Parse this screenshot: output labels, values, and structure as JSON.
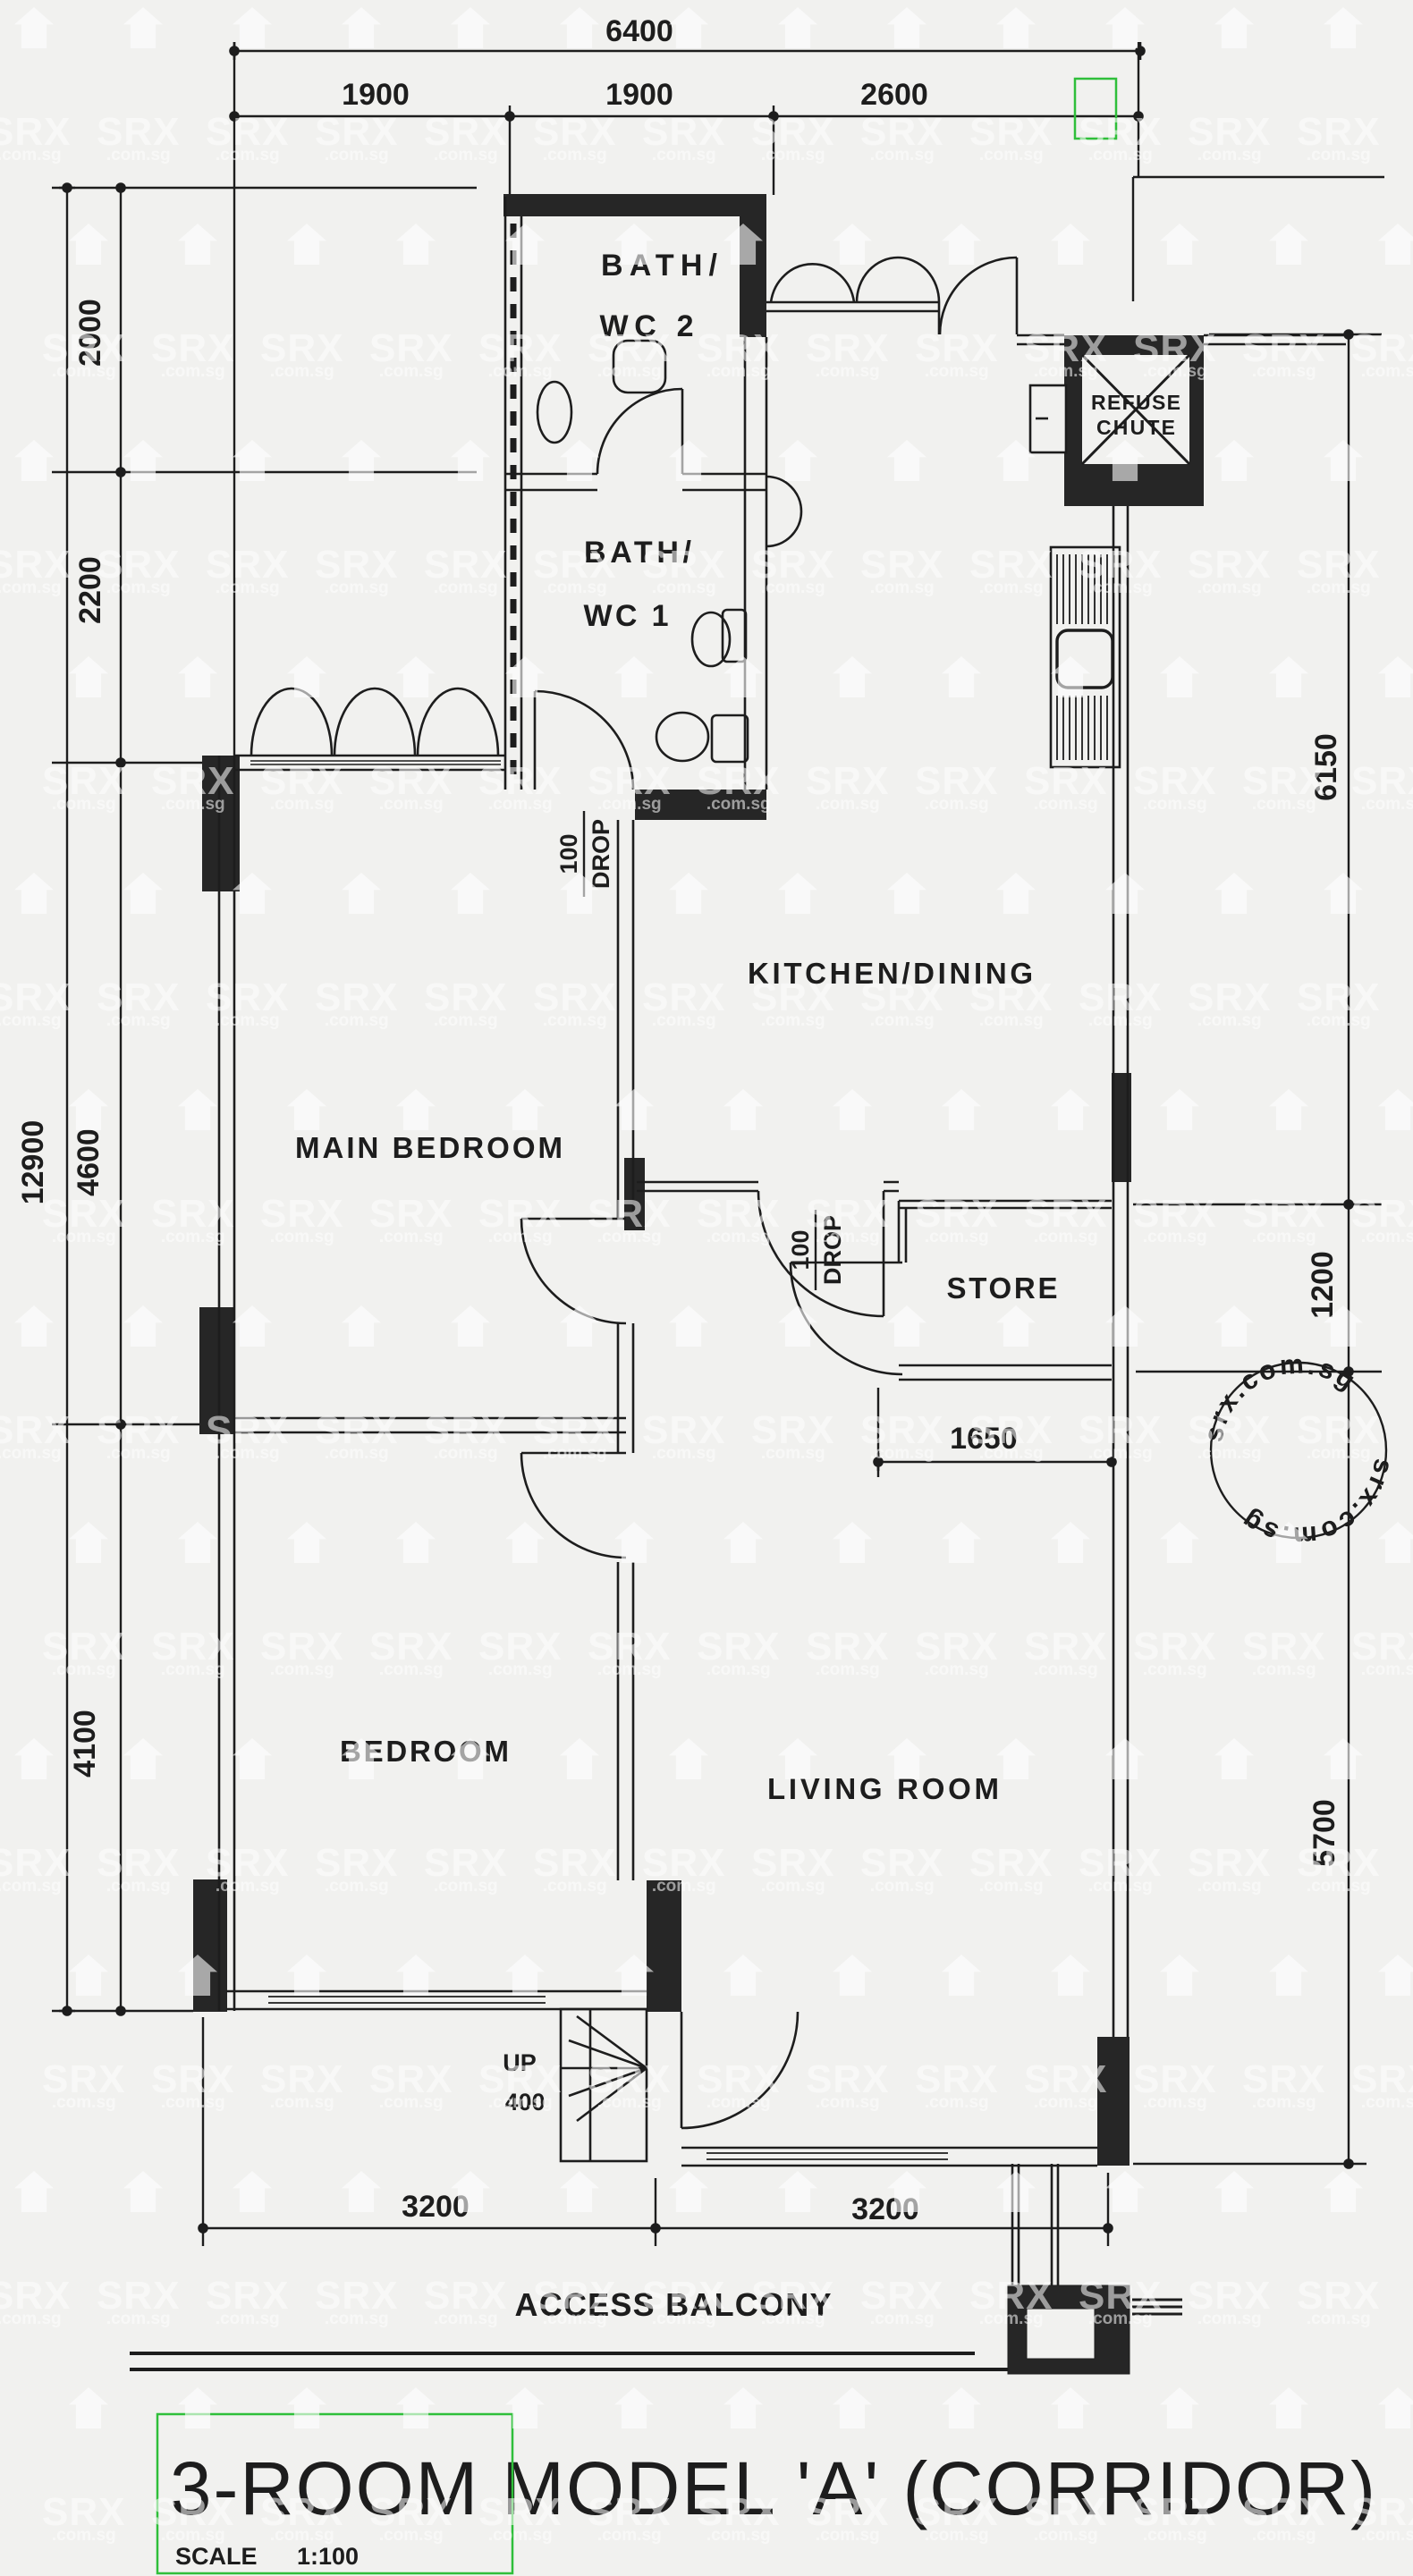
{
  "title": {
    "main": "3-ROOM MODEL 'A' (CORRIDOR)",
    "scale_label": "SCALE",
    "scale_value": "1:100"
  },
  "rooms": {
    "bath2_line1": "BATH/",
    "bath2_line2": "WC 2",
    "bath1_line1": "BATH/",
    "bath1_line2": "WC 1",
    "kitchen": "KITCHEN/DINING",
    "store": "STORE",
    "main_bedroom": "MAIN BEDROOM",
    "bedroom": "BEDROOM",
    "living": "LIVING ROOM",
    "balcony": "ACCESS BALCONY",
    "refuse_line1": "REFUSE",
    "refuse_line2": "CHUTE"
  },
  "annotations": {
    "up": "UP",
    "up_value": "400",
    "drop_bedroom_line1": "100",
    "drop_bedroom_line2": "DROP",
    "drop_kitchen_line1": "100",
    "drop_kitchen_line2": "DROP"
  },
  "dimensions": {
    "top_total": "6400",
    "top_seg1": "1900",
    "top_seg2": "1900",
    "top_seg3": "2600",
    "left_total": "12900",
    "left_seg1": "2000",
    "left_seg2": "2200",
    "left_seg3": "4600",
    "left_seg4": "4100",
    "right_seg1": "6150",
    "right_seg2": "1200",
    "right_seg3": "5700",
    "store_width": "1650",
    "bottom_seg1": "3200",
    "bottom_seg2": "3200"
  },
  "watermark": {
    "brand": "SRX",
    "domain": ".com.sg",
    "stamp_text": "srx.com.sg",
    "stamp_text2": "srx.com.sg"
  },
  "colors": {
    "paper": "#f1f1ef",
    "ink": "#1d1d1d",
    "annotation_green": "#2fbf3a",
    "watermark": "#ffffff"
  }
}
